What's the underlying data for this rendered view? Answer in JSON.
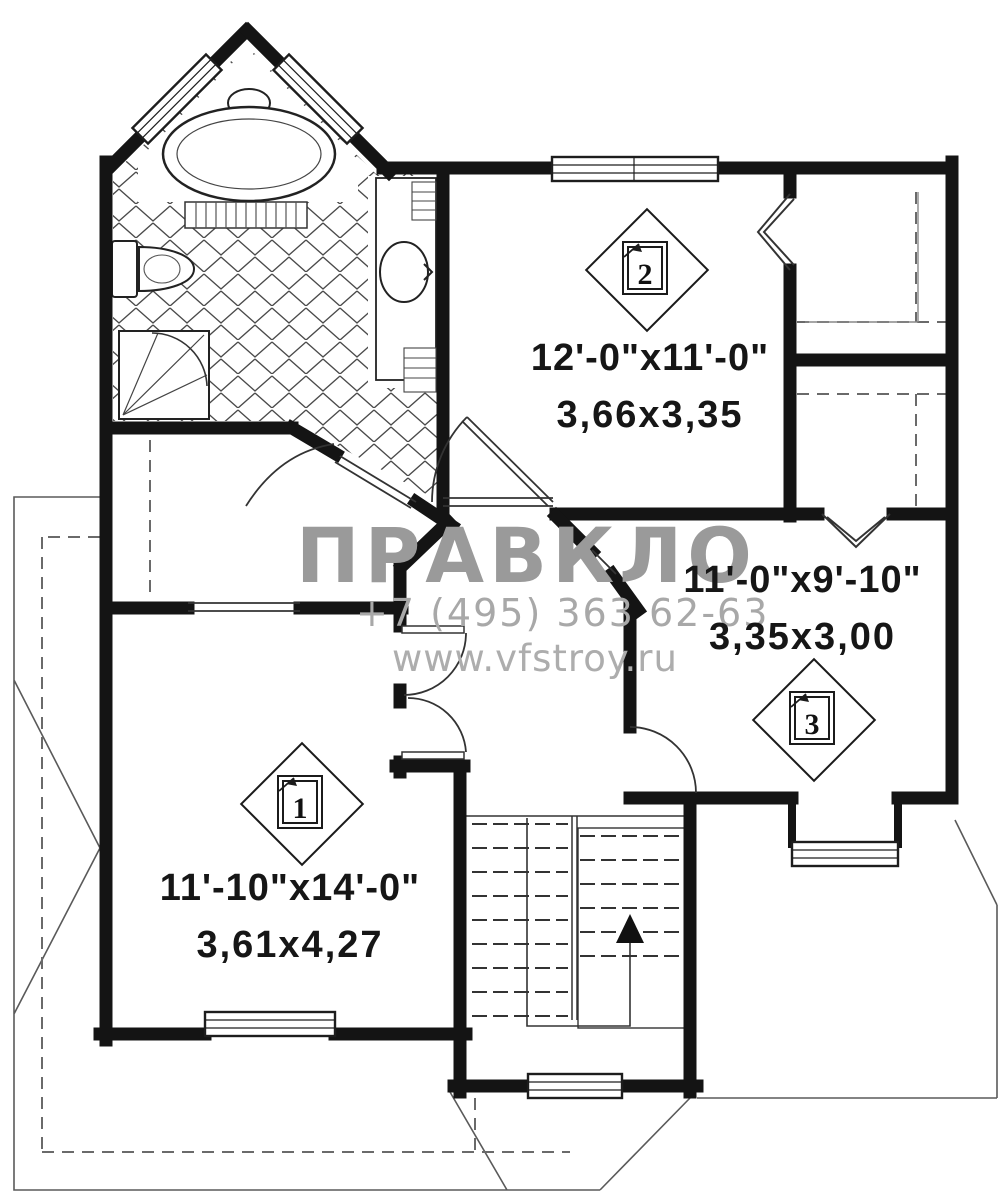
{
  "plan": {
    "type": "residential-floor-plan",
    "floor": "upper level",
    "units": "feet-inches and meters"
  },
  "rooms": [
    {
      "number": "1",
      "imperial": "11'-10\"x14'-0\"",
      "metric": "3,61x4,27"
    },
    {
      "number": "2",
      "imperial": "12'-0\"x11'-0\"",
      "metric": "3,66x3,35"
    },
    {
      "number": "3",
      "imperial": "11'-0\"x9'-10\"",
      "metric": "3,35x3,00"
    }
  ],
  "watermark": {
    "brand_left": "ПРАВ",
    "brand_right": "КЛО",
    "phone": "+7 (495) 363 62-63",
    "website": "www.vfstroy.ru"
  },
  "stairs": {
    "direction": "up"
  },
  "fixtures": [
    "bathtub",
    "toilet",
    "shower",
    "vanity-sink"
  ],
  "colors": {
    "wall": "#141414",
    "thin_line": "#333333",
    "tile_line": "#4a4a4a",
    "dashed_line": "#6a6a6a",
    "roof_line": "#5a5a5a",
    "watermark_text": "#9a9a9a",
    "background": "#ffffff"
  }
}
